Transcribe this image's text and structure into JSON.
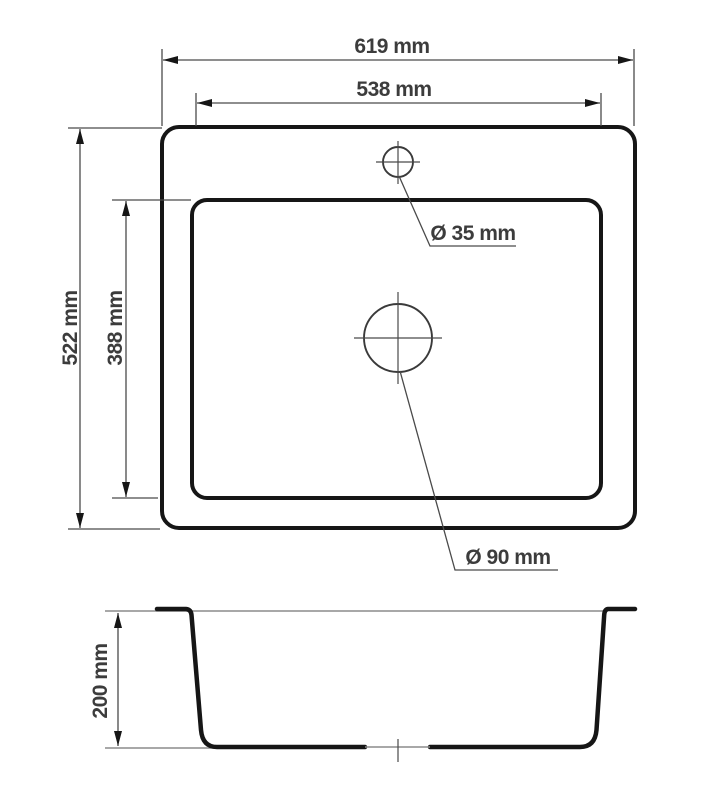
{
  "drawing": {
    "units": "mm",
    "labels": {
      "outer_width": "619 mm",
      "inner_width": "538 mm",
      "outer_length": "522 mm",
      "inner_length": "388 mm",
      "faucet_hole": "Ø 35 mm",
      "drain_hole": "Ø 90 mm",
      "depth": "200 mm"
    },
    "dimensions_mm": {
      "outer_width": 619,
      "inner_width": 538,
      "outer_length": 522,
      "inner_length": 388,
      "faucet_hole_diameter": 35,
      "drain_hole_diameter": 90,
      "bowl_depth": 200
    },
    "colors": {
      "outline": "#161616",
      "dimension_line": "#4a4a4a",
      "text": "#3c3c3c",
      "surface_line": "#8c8c8c",
      "background": "#ffffff"
    }
  }
}
